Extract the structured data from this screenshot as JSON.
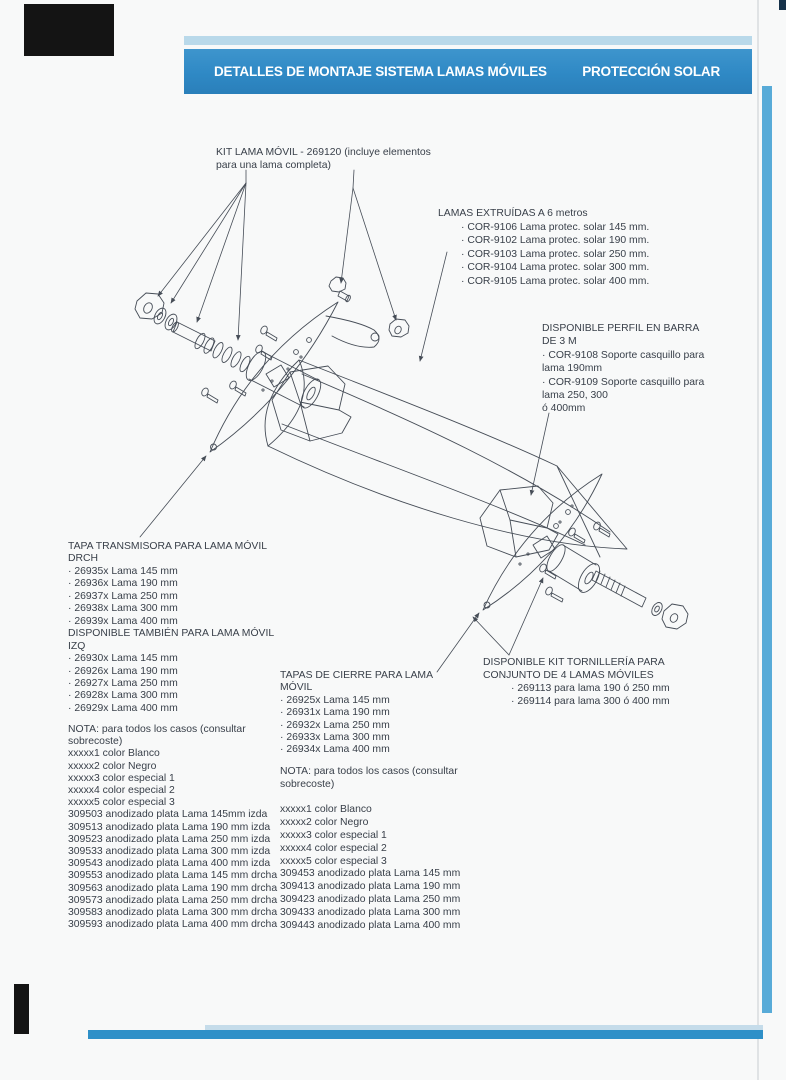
{
  "header": {
    "title": "DETALLES DE MONTAJE SISTEMA LAMAS MÓVILES",
    "right_title": "PROTECCIÓN SOLAR"
  },
  "labels": {
    "kit_lama": [
      "KIT LAMA MÓVIL - 269120 (incluye elementos",
      "para una lama completa)"
    ],
    "lamas_extruidas": {
      "title": "LAMAS EXTRUÍDAS A 6 metros",
      "items": [
        "· COR-9106 Lama protec. solar 145 mm.",
        "· COR-9102 Lama protec. solar 190 mm.",
        "· COR-9103 Lama protec. solar 250 mm.",
        "· COR-9104 Lama protec. solar 300 mm.",
        "· COR-9105 Lama protec. solar 400 mm."
      ]
    },
    "perfil_barra": [
      "DISPONIBLE PERFIL EN BARRA",
      "DE 3 M",
      "· COR-9108 Soporte casquillo para",
      "lama 190mm",
      "· COR-9109 Soporte casquillo para",
      "lama 250, 300",
      "ó 400mm"
    ],
    "tapa_transmisora": [
      "TAPA TRANSMISORA PARA LAMA MÓVIL",
      "DRCH",
      "· 26935x Lama 145 mm",
      "· 26936x Lama 190 mm",
      "· 26937x Lama 250 mm",
      "· 26938x Lama 300 mm",
      "· 26939x Lama 400 mm",
      "DISPONIBLE TAMBIÉN PARA LAMA MÓVIL",
      "IZQ",
      "· 26930x Lama 145 mm",
      "· 26926x Lama 190 mm",
      "· 26927x Lama 250 mm",
      "· 26928x Lama 300 mm",
      "· 26929x Lama 400 mm"
    ],
    "nota_izquierda": [
      "NOTA: para todos los casos (consultar",
      "sobrecoste)",
      "xxxxx1 color Blanco",
      "xxxxx2 color Negro",
      "xxxxx3 color especial 1",
      "xxxxx4 color especial 2",
      "xxxxx5 color especial 3",
      "309503 anodizado plata Lama 145mm izda",
      "309513 anodizado plata Lama 190 mm izda",
      "309523 anodizado plata Lama 250 mm izda",
      "309533 anodizado plata Lama 300 mm izda",
      "309543 anodizado plata Lama 400 mm izda",
      "309553 anodizado plata Lama 145 mm drcha",
      "309563 anodizado plata Lama 190 mm drcha",
      "309573 anodizado plata Lama 250 mm drcha",
      "309583 anodizado plata Lama 300 mm drcha",
      "309593 anodizado plata Lama 400 mm drcha"
    ],
    "tapas_cierre": [
      "TAPAS DE CIERRE PARA LAMA",
      "MÓVIL",
      "· 26925x Lama 145 mm",
      "· 26931x Lama 190 mm",
      "· 26932x Lama 250 mm",
      "· 26933x Lama 300 mm",
      "· 26934x Lama 400 mm"
    ],
    "nota_derecha": [
      "NOTA: para todos los casos (consultar",
      "sobrecoste)",
      "",
      "xxxxx1 color Blanco",
      "xxxxx2 color Negro",
      "xxxxx3 color especial 1",
      "xxxxx4 color especial 2",
      "xxxxx5 color especial 3",
      "309453 anodizado plata Lama 145 mm",
      "309413 anodizado plata Lama 190 mm",
      "309423 anodizado plata Lama 250 mm",
      "309433 anodizado plata Lama 300 mm",
      "309443 anodizado plata Lama 400 mm"
    ],
    "kit_tornilleria": {
      "title": [
        "DISPONIBLE KIT TORNILLERÍA PARA",
        "CONJUNTO DE 4 LAMAS MÓVILES"
      ],
      "items": [
        "· 269113 para lama 190 ó 250 mm",
        "· 269114 para lama 300 ó 400 mm"
      ]
    }
  },
  "colors": {
    "header_blue": "#2f89c5",
    "header_light_blue": "#b9d9ea",
    "right_stripe_blue": "#58abd8",
    "bottom_bar_blue": "#2e90c8",
    "ink": "#39404a",
    "scan_corner_black": "#141414",
    "diagram_line": "#464d57"
  }
}
